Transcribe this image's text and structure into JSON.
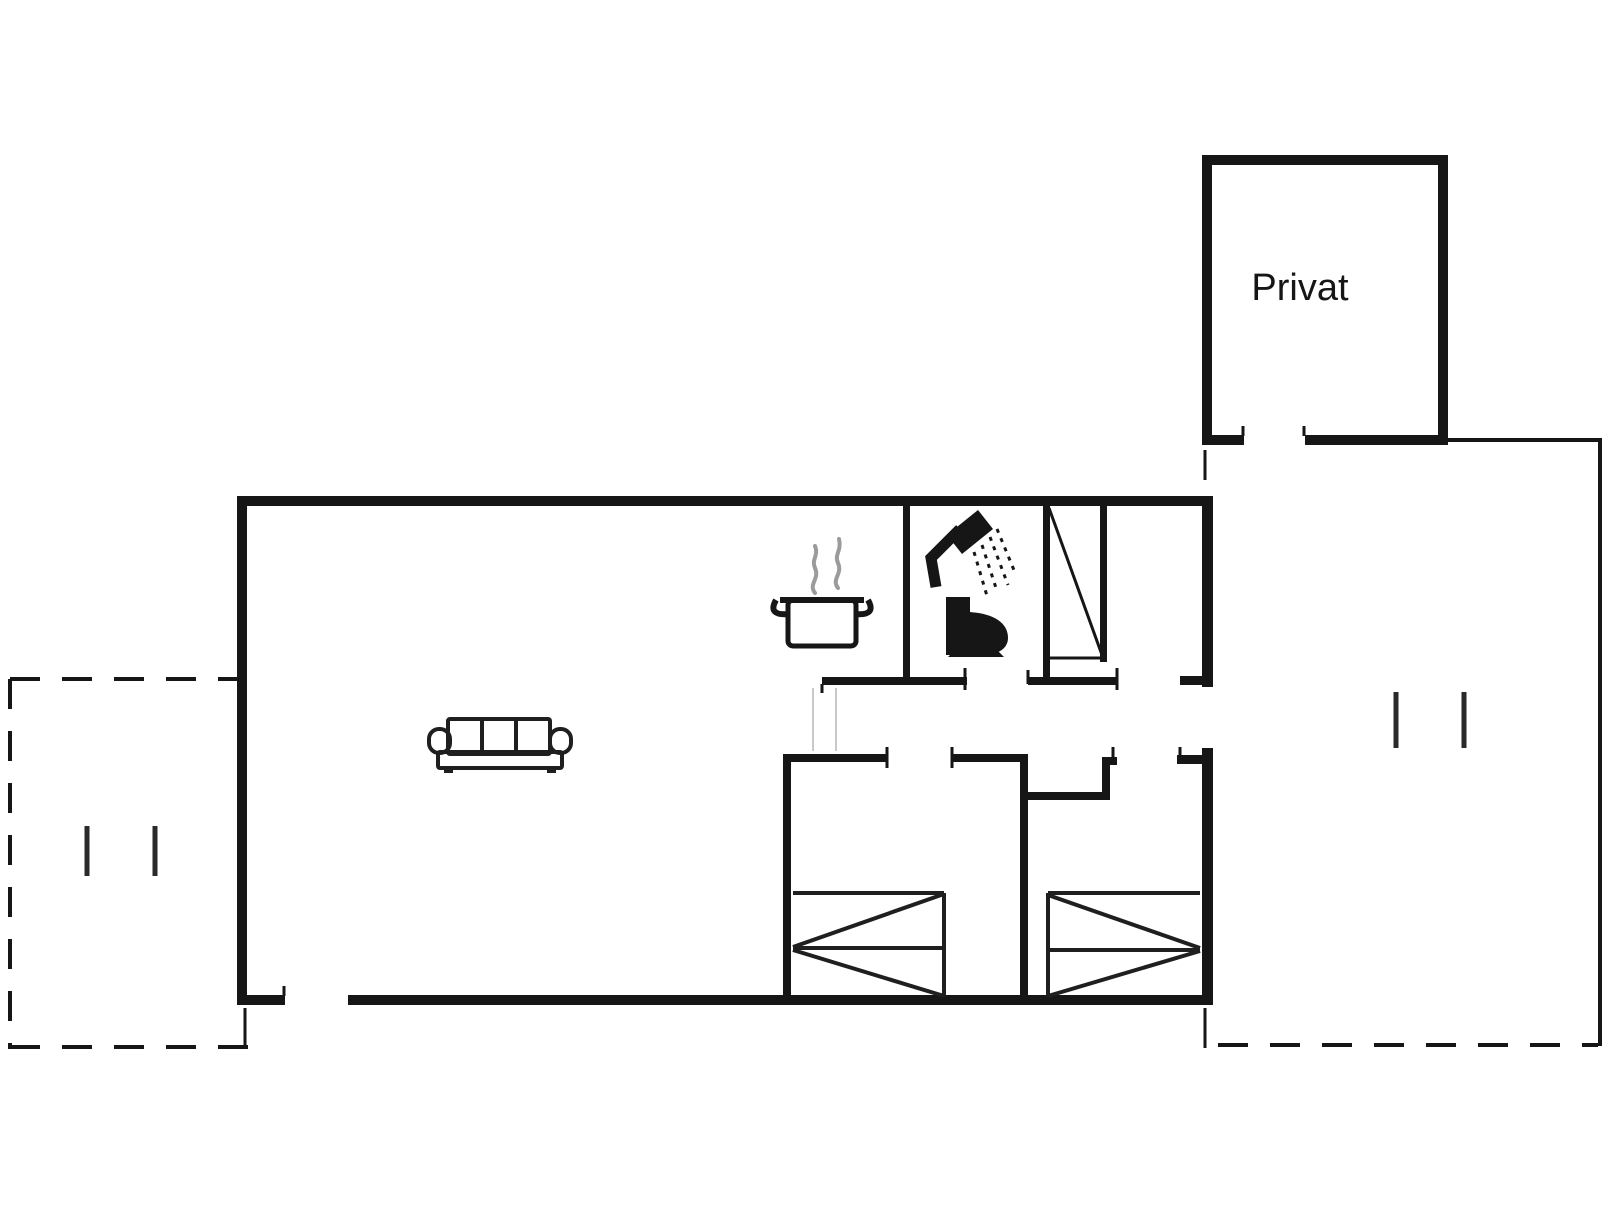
{
  "plan": {
    "type": "floor-plan",
    "labels": {
      "private_room": "Privat"
    },
    "colors": {
      "wall": "#161616",
      "line": "#1f1f1f",
      "steam": "#9b9b9b",
      "faint": "#c9c9c9",
      "mark": "#2a2a2a",
      "background": "#ffffff"
    },
    "icons": {
      "sofa": "sofa-icon",
      "cooking_pot": "cooking-pot-icon",
      "steam": "steam-icon",
      "shower": "shower-icon",
      "toilet": "toilet-icon",
      "wardrobe": "wardrobe-icon",
      "bed_left": "bed-icon",
      "bed_right": "bed-icon",
      "terrace_door_marks": "door-opening-marks",
      "annex_door_marks": "door-opening-marks"
    }
  }
}
